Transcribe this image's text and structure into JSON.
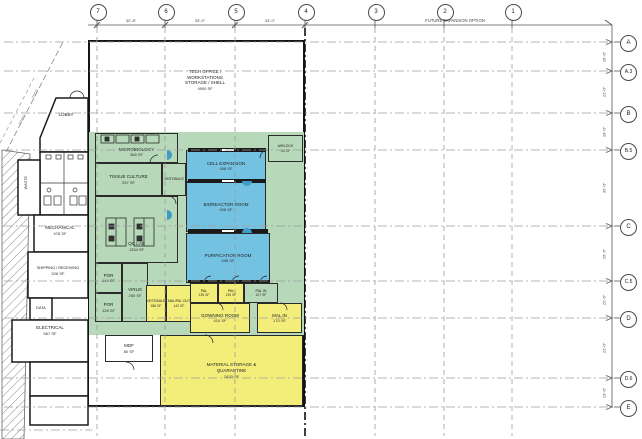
{
  "colors": {
    "lab_green": "#b7d9b9",
    "process_blue": "#74c2e1",
    "gown_yellow": "#f3ee79",
    "wall": "#141414",
    "gridline": "#9c9c9c"
  },
  "grid": {
    "future_note": "FUTURE EXPANSION OPTION",
    "columns": [
      "7",
      "6",
      "5",
      "4",
      "3",
      "2",
      "1"
    ],
    "column_dims": [
      "32'-8\"",
      "33'-0\"",
      "33'-0\""
    ],
    "rows": [
      "A",
      "A.3",
      "B",
      "B.5",
      "C",
      "C.5",
      "D",
      "D.6",
      "E"
    ],
    "row_dims": [
      "15'-0\"",
      "22'-0\"",
      "19'-0\"",
      "32'-0\"",
      "25'-6\"",
      "22'-6\"",
      "22'-0\"",
      "13'-0\""
    ]
  },
  "site": {
    "utility_1": "SSCO",
    "utility_2": "SSCO"
  },
  "rooms": {
    "tech_office": {
      "l1": "TECH OFFICE /",
      "l2": "WORKSTATIONS",
      "l3": "STORAGE / SHELL",
      "area": "4900 SF"
    },
    "microbiology": {
      "label": "MICROBIOLOGY",
      "area": "368 SF"
    },
    "tissue_culture": {
      "label": "TISSUE CULTURE",
      "area": "257 SF"
    },
    "vestibule_upper": {
      "label": "VESTIBULE"
    },
    "qc_lab": {
      "label": "QC LAB",
      "area": "1334 SF"
    },
    "por_1": {
      "label": "POR",
      "area": "144 SF"
    },
    "por_2": {
      "label": "POR",
      "area": "128 SF"
    },
    "virus": {
      "label": "VIRUS",
      "area": "260 SF"
    },
    "vestibule_lower": {
      "label": "VESTIBULE",
      "area": "186 SF"
    },
    "mal_pal_out": {
      "label": "MAL/PAL OUT",
      "area": "142 SF"
    },
    "cell_expansion": {
      "label": "CELL EXPANSION",
      "area": "458 SF"
    },
    "airlock": {
      "label": "AIRLOCK",
      "area": "63 SF"
    },
    "bioreactor": {
      "label": "BIOREACTOR ROOM",
      "area": "608 SF"
    },
    "purification": {
      "label": "PURIFICATION ROOM",
      "area": "698 SF"
    },
    "pal_1": {
      "label": "PAL",
      "area": "135 SF"
    },
    "pal_2": {
      "label": "PAL",
      "area": "135 SF"
    },
    "pal_in": {
      "label": "PAL IN",
      "area": "107 SF"
    },
    "gowning": {
      "label": "GOWNING ROOM",
      "area": "410 SF"
    },
    "mal_in": {
      "label": "MAL IN",
      "area": "170 SF"
    },
    "material_storage": {
      "l1": "MATERIAL STORAGE &",
      "l2": "QUARANTINE",
      "area": "2430 SF"
    },
    "mdf": {
      "label": "MDF",
      "area": "80 SF"
    },
    "lobby": {
      "label": "LOBBY"
    },
    "waste": {
      "label": "WASTE"
    },
    "mechanical": {
      "label": "MECHANICAL",
      "area": "478 SF"
    },
    "shipping": {
      "label": "SHIPPING / RECEIVING",
      "area": "528 SF"
    },
    "data": {
      "label": "DATA"
    },
    "electrical": {
      "label": "ELECTRICAL",
      "area": "667 SF"
    }
  }
}
